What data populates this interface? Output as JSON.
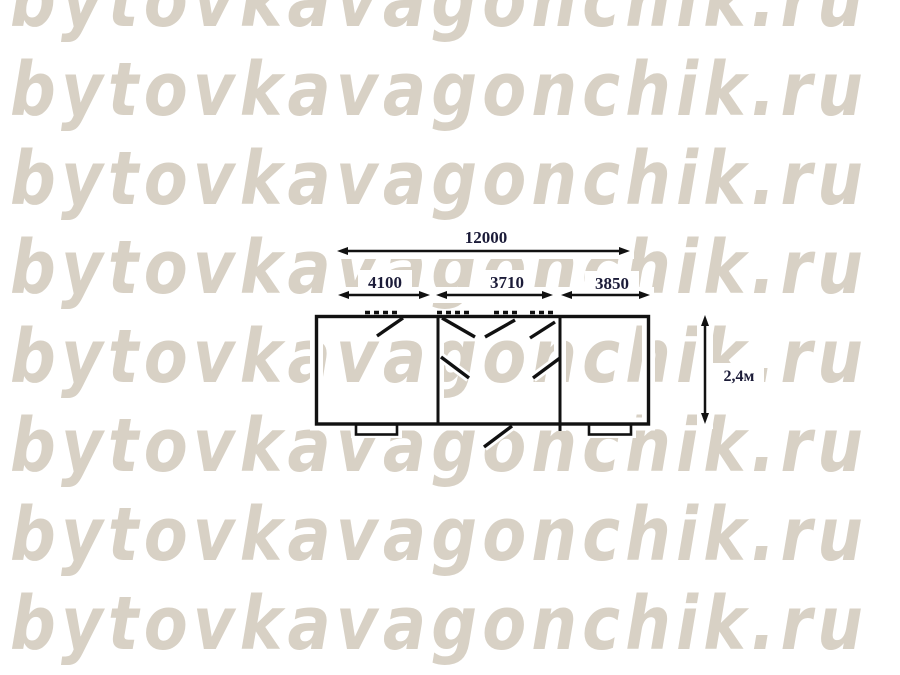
{
  "watermark": {
    "text": "bytovkavagonchik.ru",
    "color": "#d8d1c5",
    "row_count": 8
  },
  "diagram": {
    "type": "building-plan",
    "line_color": "#111111",
    "dimensions": {
      "total_length": "12000",
      "section1": "4100",
      "section2": "3710",
      "section3": "3850",
      "height": "2,4м"
    },
    "sections": 3,
    "door_swings": 7,
    "support_feet": 2
  }
}
